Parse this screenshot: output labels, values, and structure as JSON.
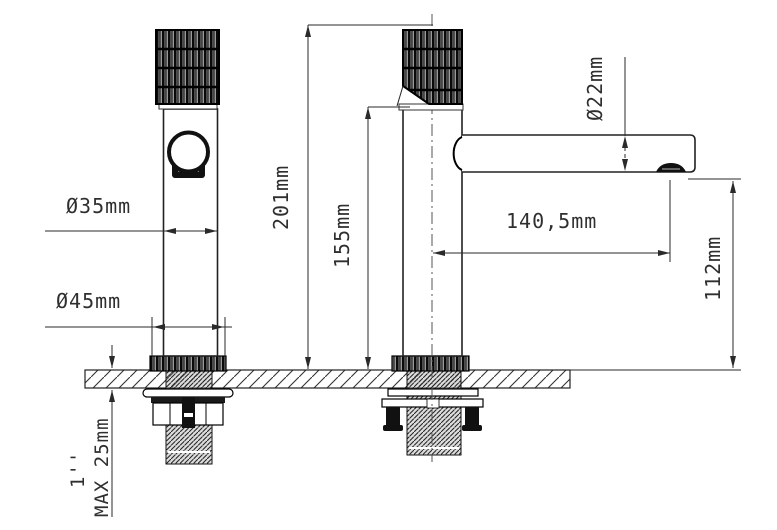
{
  "page": {
    "background": "#ffffff"
  },
  "drawing": {
    "type": "technical-dimension-drawing",
    "subject": "single-lever basin faucet, front view and side view with installation cut-away",
    "line_color": "#2a2a2a",
    "fill_dark": "#111111",
    "labels": {
      "dia_body": "Ø35mm",
      "dia_base": "Ø45mm",
      "total_height": "201mm",
      "body_height": "155mm",
      "dia_spout": "Ø22mm",
      "spout_reach": "140,5mm",
      "spout_height": "112mm",
      "max_counter_thickness": "MAX 25mm",
      "thread_size": "1''"
    }
  }
}
